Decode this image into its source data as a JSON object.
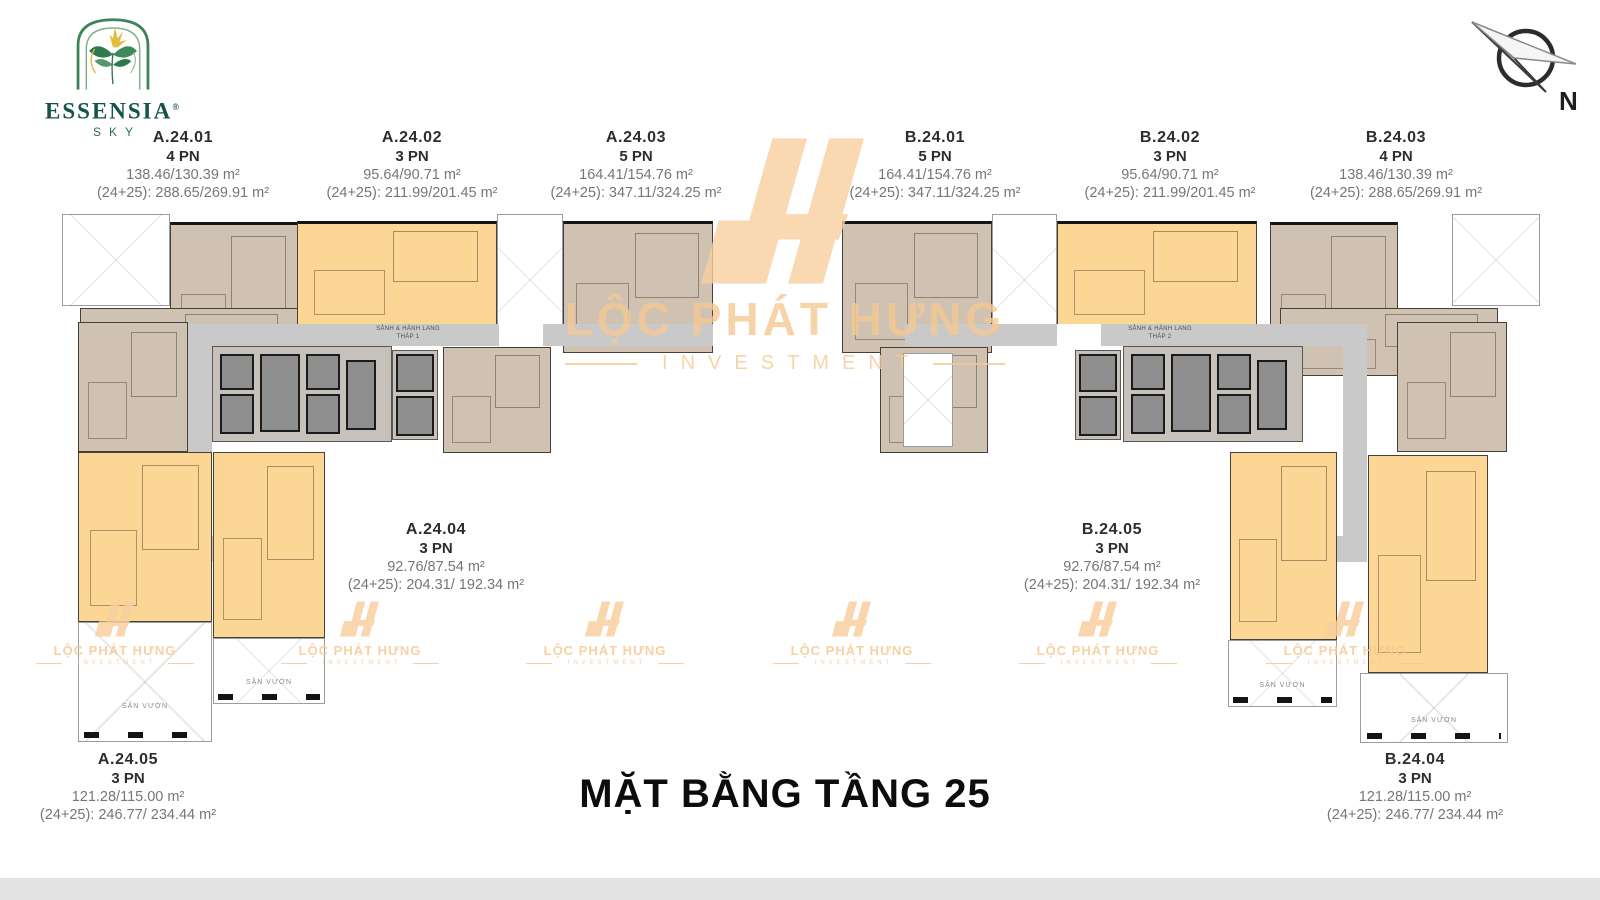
{
  "brand": {
    "name": "ESSENSIA",
    "reg": "®",
    "sub": "SKY"
  },
  "compass": {
    "label": "N"
  },
  "title": "MẶT BẰNG TẦNG 25",
  "watermark": {
    "line1": "LỘC PHÁT HƯNG",
    "line2": "INVESTMENT"
  },
  "units": [
    {
      "id": "A.24.01",
      "bedrooms": "4 PN",
      "area": "138.46/130.39 m²",
      "combined": "(24+25): 288.65/269.91 m²"
    },
    {
      "id": "A.24.02",
      "bedrooms": "3 PN",
      "area": "95.64/90.71 m²",
      "combined": "(24+25): 211.99/201.45 m²"
    },
    {
      "id": "A.24.03",
      "bedrooms": "5 PN",
      "area": "164.41/154.76 m²",
      "combined": "(24+25): 347.11/324.25 m²"
    },
    {
      "id": "B.24.01",
      "bedrooms": "5 PN",
      "area": "164.41/154.76 m²",
      "combined": "(24+25): 347.11/324.25 m²"
    },
    {
      "id": "B.24.02",
      "bedrooms": "3 PN",
      "area": "95.64/90.71 m²",
      "combined": "(24+25): 211.99/201.45 m²"
    },
    {
      "id": "B.24.03",
      "bedrooms": "4 PN",
      "area": "138.46/130.39 m²",
      "combined": "(24+25): 288.65/269.91 m²"
    },
    {
      "id": "A.24.04",
      "bedrooms": "3 PN",
      "area": "92.76/87.54 m²",
      "combined": "(24+25): 204.31/ 192.34 m²"
    },
    {
      "id": "B.24.05",
      "bedrooms": "3 PN",
      "area": "92.76/87.54 m²",
      "combined": "(24+25): 204.31/ 192.34 m²"
    },
    {
      "id": "A.24.05",
      "bedrooms": "3 PN",
      "area": "121.28/115.00 m²",
      "combined": "(24+25): 246.77/ 234.44 m²"
    },
    {
      "id": "B.24.04",
      "bedrooms": "3 PN",
      "area": "121.28/115.00 m²",
      "combined": "(24+25): 246.77/ 234.44 m²"
    }
  ],
  "plan_labels": {
    "hall_line1": "SẢNH & HÀNH LANG",
    "hall_a_line2": "THÁP 1",
    "hall_b_line2": "THÁP 2",
    "garden": "SÂN VƯỜN"
  },
  "colors": {
    "unit-yellow": "#fbd695",
    "unit-tan": "#cfc2b3",
    "corridor": "#c9c9c9",
    "core-bg": "#c6c1bb",
    "shaft": "#8f8f8f",
    "wall": "#474038",
    "label-dark": "#2d2d2d",
    "label-gray": "#767676",
    "watermark": "#f6c993",
    "logo-text": "#14544a",
    "title-black": "#0c0c0c",
    "bottom-bar": "#e3e3e3"
  }
}
